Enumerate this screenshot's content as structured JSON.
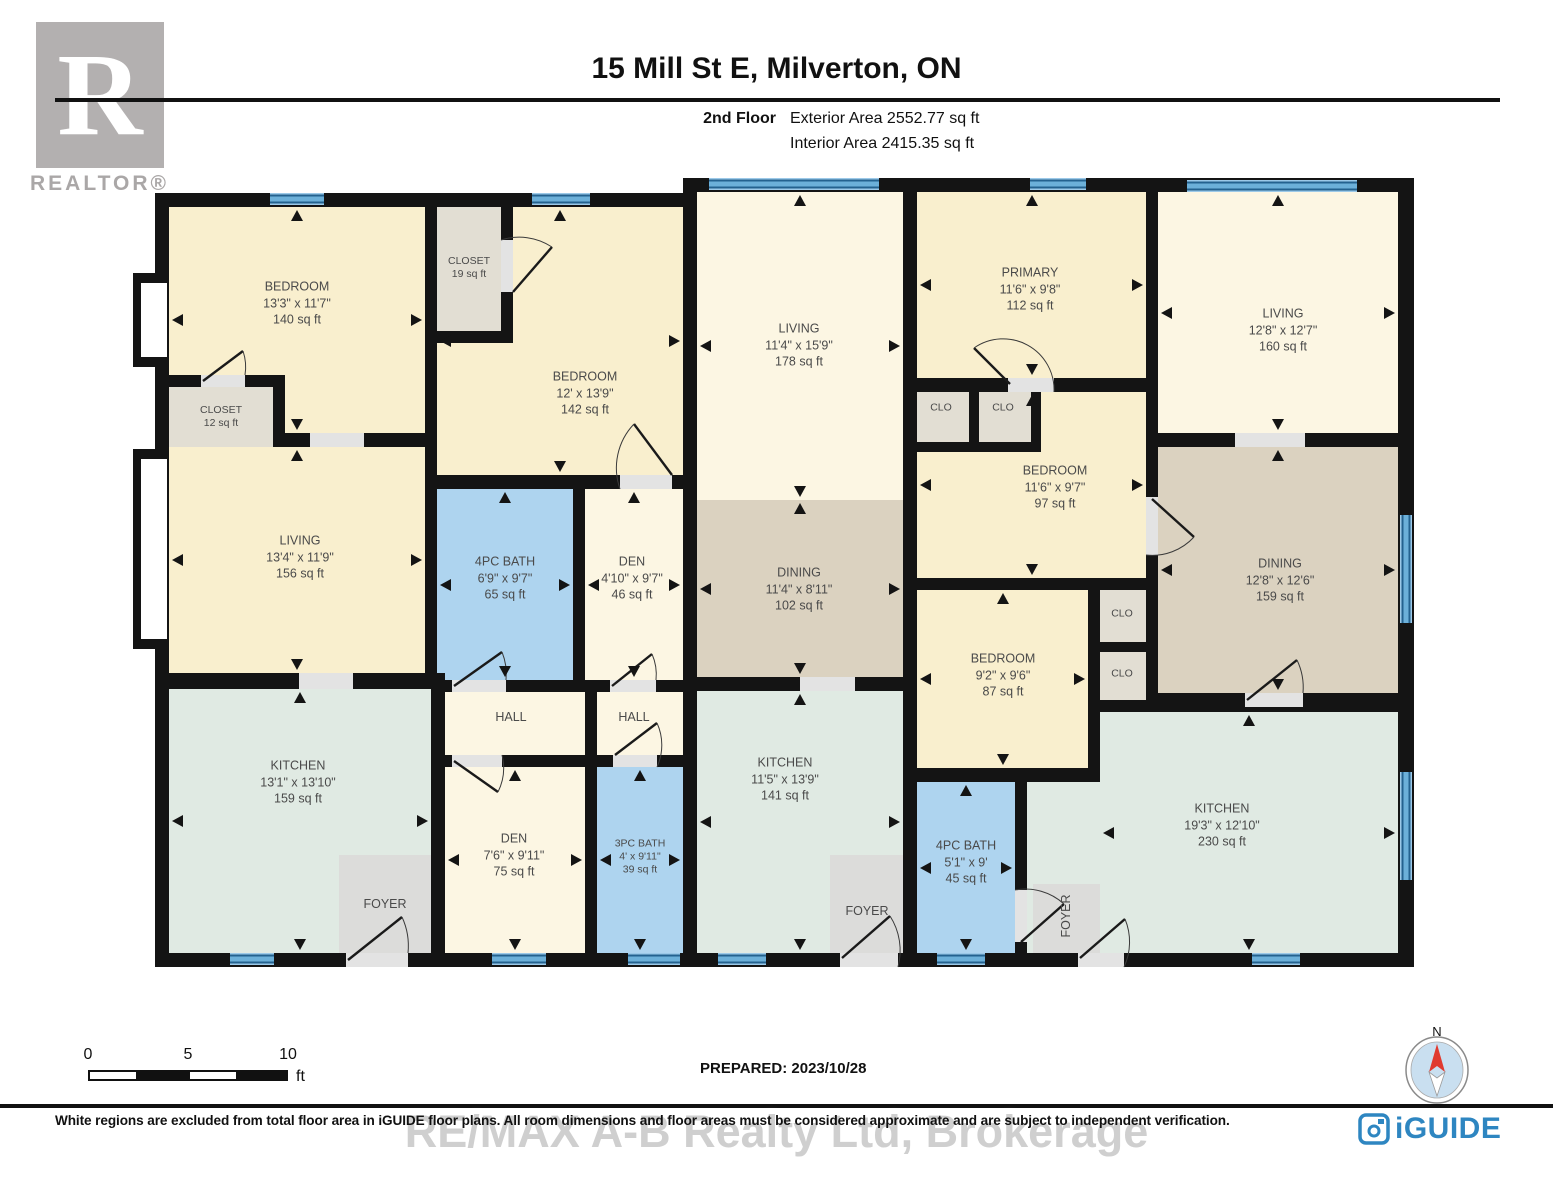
{
  "header": {
    "title": "15 Mill St E, Milverton, ON",
    "floor": "2nd Floor",
    "exterior_area": "Exterior Area 2552.77 sq ft",
    "interior_area": "Interior Area 2415.35 sq ft"
  },
  "branding": {
    "realtor_r": "R",
    "realtor_text": "REALTOR®",
    "iguide_text": "iGUIDE"
  },
  "prepared": "PREPARED: 2023/10/28",
  "compass_label": "N",
  "watermark": "RE/MAX A-B Realty Ltd, Brokerage",
  "footer": "White regions are excluded from total floor area in iGUIDE floor plans. All room dimensions and floor areas must be considered approximate and are subject to independent verification.",
  "scale_bar": {
    "labels": [
      "0",
      "5",
      "10"
    ],
    "unit": "ft"
  },
  "palette": {
    "cream": "#f9efce",
    "pale": "#fcf6e3",
    "tan": "#dbd2c0",
    "mint": "#e0eae3",
    "blue": "#aed4ef",
    "gray": "#e2ded3",
    "fgray": "#dcdcda",
    "wall": "#141414"
  },
  "plan": {
    "bases": [
      {
        "r": [
          155,
          193,
          542,
          774
        ]
      },
      {
        "r": [
          683,
          178,
          731,
          789
        ]
      }
    ],
    "niches": [
      {
        "b": [
          133,
          273,
          42,
          94
        ],
        "w": [
          141,
          283,
          26,
          74
        ]
      },
      {
        "b": [
          133,
          449,
          42,
          200
        ],
        "w": [
          141,
          459,
          26,
          180
        ]
      }
    ],
    "rooms": [
      {
        "id": "bedroom-1",
        "r": [
          169,
          207,
          256,
          226
        ],
        "fill": "cream",
        "arrows": true,
        "label": {
          "lines": [
            "BEDROOM",
            "13'3\" x 11'7\"",
            "140 sq ft"
          ],
          "cx": 297,
          "cy": 303
        }
      },
      {
        "id": "bedroom-2",
        "r": [
          513,
          207,
          170,
          268
        ],
        "fill": "cream",
        "arrows": true,
        "arrowRect": [
          437,
          207,
          246,
          268
        ],
        "label": {
          "lines": [
            "BEDROOM",
            "12' x 13'9\"",
            "142 sq ft"
          ],
          "cx": 585,
          "cy": 393
        }
      },
      {
        "id": "bedroom-2-ext",
        "r": [
          437,
          343,
          76,
          132
        ],
        "fill": "cream"
      },
      {
        "id": "closet-19",
        "r": [
          437,
          207,
          64,
          124
        ],
        "fill": "gray",
        "label": {
          "lines": [
            "CLOSET",
            "19 sq ft"
          ],
          "cx": 469,
          "cy": 268,
          "small": true
        }
      },
      {
        "id": "closet-12",
        "r": [
          169,
          387,
          104,
          60
        ],
        "fill": "gray",
        "label": {
          "lines": [
            "CLOSET",
            "12 sq ft"
          ],
          "cx": 221,
          "cy": 417,
          "small": true
        }
      },
      {
        "id": "living-1",
        "r": [
          169,
          447,
          256,
          226
        ],
        "fill": "cream",
        "arrows": true,
        "label": {
          "lines": [
            "LIVING",
            "13'4\" x 11'9\"",
            "156 sq ft"
          ],
          "cx": 300,
          "cy": 557
        }
      },
      {
        "id": "bath-4pc-1",
        "r": [
          437,
          489,
          136,
          191
        ],
        "fill": "blue",
        "arrows": true,
        "label": {
          "lines": [
            "4PC BATH",
            "6'9\" x 9'7\"",
            "65 sq ft"
          ],
          "cx": 505,
          "cy": 578
        }
      },
      {
        "id": "den-1",
        "r": [
          585,
          489,
          98,
          191
        ],
        "fill": "pale",
        "arrows": true,
        "label": {
          "lines": [
            "DEN",
            "4'10\" x 9'7\"",
            "46 sq ft"
          ],
          "cx": 632,
          "cy": 578
        }
      },
      {
        "id": "hall-1",
        "r": [
          445,
          692,
          140,
          63
        ],
        "fill": "pale",
        "label": {
          "lines": [
            "HALL"
          ],
          "cx": 511,
          "cy": 717
        }
      },
      {
        "id": "hall-2",
        "r": [
          597,
          692,
          86,
          63
        ],
        "fill": "pale",
        "label": {
          "lines": [
            "HALL"
          ],
          "cx": 634,
          "cy": 717
        }
      },
      {
        "id": "kitchen-1",
        "r": [
          169,
          689,
          262,
          264
        ],
        "fill": "mint",
        "arrows": true,
        "label": {
          "lines": [
            "KITCHEN",
            "13'1\" x 13'10\"",
            "159 sq ft"
          ],
          "cx": 298,
          "cy": 782
        }
      },
      {
        "id": "foyer-1",
        "r": [
          339,
          855,
          92,
          98
        ],
        "fill": "fgray",
        "label": {
          "lines": [
            "FOYER"
          ],
          "cx": 385,
          "cy": 904
        }
      },
      {
        "id": "den-2",
        "r": [
          445,
          767,
          140,
          186
        ],
        "fill": "pale",
        "arrows": true,
        "label": {
          "lines": [
            "DEN",
            "7'6\" x 9'11\"",
            "75 sq ft"
          ],
          "cx": 514,
          "cy": 855
        }
      },
      {
        "id": "bath-3pc",
        "r": [
          597,
          767,
          86,
          186
        ],
        "fill": "blue",
        "arrows": true,
        "label": {
          "lines": [
            "3PC BATH",
            "4' x 9'11\"",
            "39 sq ft"
          ],
          "cx": 640,
          "cy": 857,
          "small": true
        }
      },
      {
        "id": "living-2",
        "r": [
          697,
          192,
          206,
          308
        ],
        "fill": "pale",
        "arrows": true,
        "label": {
          "lines": [
            "LIVING",
            "11'4\" x 15'9\"",
            "178 sq ft"
          ],
          "cx": 799,
          "cy": 345
        }
      },
      {
        "id": "dining-1",
        "r": [
          697,
          500,
          206,
          177
        ],
        "fill": "tan",
        "arrows": true,
        "label": {
          "lines": [
            "DINING",
            "11'4\" x 8'11\"",
            "102 sq ft"
          ],
          "cx": 799,
          "cy": 589
        }
      },
      {
        "id": "kitchen-2",
        "r": [
          697,
          691,
          206,
          262
        ],
        "fill": "mint",
        "arrows": true,
        "label": {
          "lines": [
            "KITCHEN",
            "11'5\" x 13'9\"",
            "141 sq ft"
          ],
          "cx": 785,
          "cy": 779
        }
      },
      {
        "id": "foyer-2",
        "r": [
          830,
          855,
          73,
          98
        ],
        "fill": "fgray",
        "label": {
          "lines": [
            "FOYER"
          ],
          "cx": 867,
          "cy": 911
        }
      },
      {
        "id": "primary",
        "r": [
          917,
          192,
          229,
          186
        ],
        "fill": "cream",
        "arrows": true,
        "label": {
          "lines": [
            "PRIMARY",
            "11'6\" x 9'8\"",
            "112 sq ft"
          ],
          "cx": 1030,
          "cy": 289
        }
      },
      {
        "id": "bedroom-97",
        "r": [
          917,
          392,
          229,
          186
        ],
        "fill": "cream",
        "arrows": true,
        "label": {
          "lines": [
            "BEDROOM",
            "11'6\" x 9'7\"",
            "97 sq ft"
          ],
          "cx": 1055,
          "cy": 487
        }
      },
      {
        "id": "clo-a",
        "r": [
          917,
          392,
          52,
          50
        ],
        "fill": "gray",
        "label": {
          "lines": [
            "CLO"
          ],
          "cx": 941,
          "cy": 408,
          "small": true
        }
      },
      {
        "id": "clo-b",
        "r": [
          979,
          392,
          52,
          50
        ],
        "fill": "gray",
        "label": {
          "lines": [
            "CLO"
          ],
          "cx": 1003,
          "cy": 408,
          "small": true
        }
      },
      {
        "id": "bedroom-87",
        "r": [
          917,
          590,
          171,
          178
        ],
        "fill": "cream",
        "arrows": true,
        "label": {
          "lines": [
            "BEDROOM",
            "9'2\" x 9'6\"",
            "87 sq ft"
          ],
          "cx": 1003,
          "cy": 675
        }
      },
      {
        "id": "clo-c",
        "r": [
          1100,
          590,
          46,
          52
        ],
        "fill": "gray",
        "label": {
          "lines": [
            "CLO"
          ],
          "cx": 1122,
          "cy": 614,
          "small": true
        }
      },
      {
        "id": "clo-d",
        "r": [
          1100,
          652,
          46,
          48
        ],
        "fill": "gray",
        "label": {
          "lines": [
            "CLO"
          ],
          "cx": 1122,
          "cy": 674,
          "small": true
        }
      },
      {
        "id": "bath-4pc-2",
        "r": [
          917,
          782,
          98,
          171
        ],
        "fill": "blue",
        "arrows": true,
        "label": {
          "lines": [
            "4PC BATH",
            "5'1\" x 9'",
            "45 sq ft"
          ],
          "cx": 966,
          "cy": 862
        }
      },
      {
        "id": "living-3",
        "r": [
          1158,
          192,
          240,
          241
        ],
        "fill": "pale",
        "arrows": true,
        "label": {
          "lines": [
            "LIVING",
            "12'8\" x 12'7\"",
            "160 sq ft"
          ],
          "cx": 1283,
          "cy": 330
        }
      },
      {
        "id": "dining-2",
        "r": [
          1158,
          447,
          240,
          246
        ],
        "fill": "tan",
        "arrows": true,
        "label": {
          "lines": [
            "DINING",
            "12'8\" x 12'6\"",
            "159 sq ft"
          ],
          "cx": 1280,
          "cy": 580
        }
      },
      {
        "id": "kitchen-3",
        "r": [
          1100,
          712,
          298,
          241
        ],
        "fill": "mint",
        "arrows": true,
        "label": {
          "lines": [
            "KITCHEN",
            "19'3\" x 12'10\"",
            "230 sq ft"
          ],
          "cx": 1222,
          "cy": 825
        }
      },
      {
        "id": "kitchen-3-ext",
        "r": [
          1027,
          782,
          73,
          171
        ],
        "fill": "mint"
      },
      {
        "id": "foyer-3",
        "r": [
          1033,
          884,
          67,
          69
        ],
        "fill": "fgray",
        "label": {
          "lines": [
            "FOYER"
          ],
          "cx": 1066,
          "cy": 916,
          "rot": true
        }
      }
    ],
    "walls": [
      [
        425,
        207,
        12,
        466
      ],
      [
        273,
        433,
        164,
        14
      ],
      [
        169,
        375,
        104,
        12
      ],
      [
        273,
        375,
        12,
        72
      ],
      [
        501,
        207,
        12,
        124
      ],
      [
        437,
        331,
        76,
        12
      ],
      [
        437,
        475,
        246,
        14
      ],
      [
        573,
        489,
        12,
        191
      ],
      [
        437,
        680,
        246,
        12
      ],
      [
        585,
        692,
        12,
        63
      ],
      [
        437,
        755,
        246,
        12
      ],
      [
        169,
        673,
        262,
        16
      ],
      [
        431,
        673,
        14,
        280
      ],
      [
        585,
        767,
        12,
        186
      ],
      [
        903,
        192,
        14,
        761
      ],
      [
        917,
        378,
        229,
        14
      ],
      [
        969,
        392,
        10,
        50
      ],
      [
        917,
        442,
        62,
        10
      ],
      [
        1031,
        392,
        10,
        50
      ],
      [
        979,
        442,
        62,
        10
      ],
      [
        917,
        578,
        229,
        12
      ],
      [
        1088,
        590,
        12,
        185
      ],
      [
        1100,
        642,
        46,
        10
      ],
      [
        1100,
        700,
        46,
        12
      ],
      [
        917,
        768,
        183,
        14
      ],
      [
        1015,
        782,
        12,
        171
      ],
      [
        697,
        677,
        206,
        14
      ],
      [
        1146,
        192,
        12,
        515
      ],
      [
        1158,
        433,
        240,
        14
      ],
      [
        1158,
        693,
        242,
        14
      ]
    ],
    "windows": [
      {
        "r": [
          270,
          193,
          54,
          12
        ],
        "v": false
      },
      {
        "r": [
          532,
          193,
          58,
          12
        ],
        "v": false
      },
      {
        "r": [
          709,
          178,
          170,
          12
        ],
        "v": false
      },
      {
        "r": [
          1030,
          178,
          56,
          12
        ],
        "v": false
      },
      {
        "r": [
          1187,
          180,
          170,
          12
        ],
        "v": false
      },
      {
        "r": [
          230,
          953,
          44,
          12
        ],
        "v": false
      },
      {
        "r": [
          492,
          953,
          54,
          12
        ],
        "v": false
      },
      {
        "r": [
          628,
          953,
          52,
          12
        ],
        "v": false
      },
      {
        "r": [
          718,
          953,
          48,
          12
        ],
        "v": false
      },
      {
        "r": [
          937,
          953,
          48,
          12
        ],
        "v": false
      },
      {
        "r": [
          1252,
          953,
          48,
          12
        ],
        "v": false
      },
      {
        "r": [
          1400,
          515,
          12,
          108
        ],
        "v": true
      },
      {
        "r": [
          1400,
          772,
          12,
          108
        ],
        "v": true
      }
    ],
    "doors": [
      {
        "gap": [
          310,
          433,
          54,
          14
        ]
      },
      {
        "gap": [
          201,
          375,
          44,
          12
        ],
        "leaf": [
          203,
          381,
          243,
          351
        ]
      },
      {
        "gap": [
          501,
          240,
          12,
          52
        ],
        "leaf": [
          513,
          292,
          552,
          247
        ]
      },
      {
        "gap": [
          620,
          475,
          52,
          14
        ],
        "leaf": [
          672,
          475,
          634,
          424
        ]
      },
      {
        "gap": [
          452,
          680,
          54,
          12
        ],
        "leaf": [
          454,
          686,
          502,
          652
        ]
      },
      {
        "gap": [
          610,
          680,
          46,
          12
        ],
        "leaf": [
          612,
          686,
          652,
          654
        ]
      },
      {
        "gap": [
          452,
          755,
          50,
          12
        ],
        "leaf": [
          454,
          761,
          498,
          792
        ]
      },
      {
        "gap": [
          613,
          755,
          44,
          12
        ],
        "leaf": [
          615,
          755,
          657,
          723
        ]
      },
      {
        "gap": [
          346,
          953,
          62,
          14
        ],
        "leaf": [
          348,
          960,
          402,
          917
        ]
      },
      {
        "gap": [
          299,
          673,
          54,
          16
        ]
      },
      {
        "gap": [
          800,
          677,
          55,
          14
        ]
      },
      {
        "gap": [
          840,
          953,
          58,
          14
        ],
        "leaf": [
          842,
          958,
          890,
          916
        ]
      },
      {
        "gap": [
          1015,
          890,
          12,
          52
        ],
        "leaf": [
          1021,
          942,
          1064,
          904
        ]
      },
      {
        "gap": [
          1008,
          378,
          46,
          14
        ],
        "leaf": [
          1010,
          384,
          974,
          348
        ]
      },
      {
        "gap": [
          1146,
          497,
          12,
          58
        ],
        "leaf": [
          1152,
          499,
          1194,
          537
        ]
      },
      {
        "gap": [
          1235,
          433,
          70,
          14
        ]
      },
      {
        "gap": [
          1245,
          693,
          58,
          14
        ],
        "leaf": [
          1247,
          700,
          1297,
          660
        ]
      },
      {
        "gap": [
          1078,
          953,
          46,
          14
        ],
        "leaf": [
          1080,
          958,
          1125,
          919
        ]
      }
    ]
  }
}
